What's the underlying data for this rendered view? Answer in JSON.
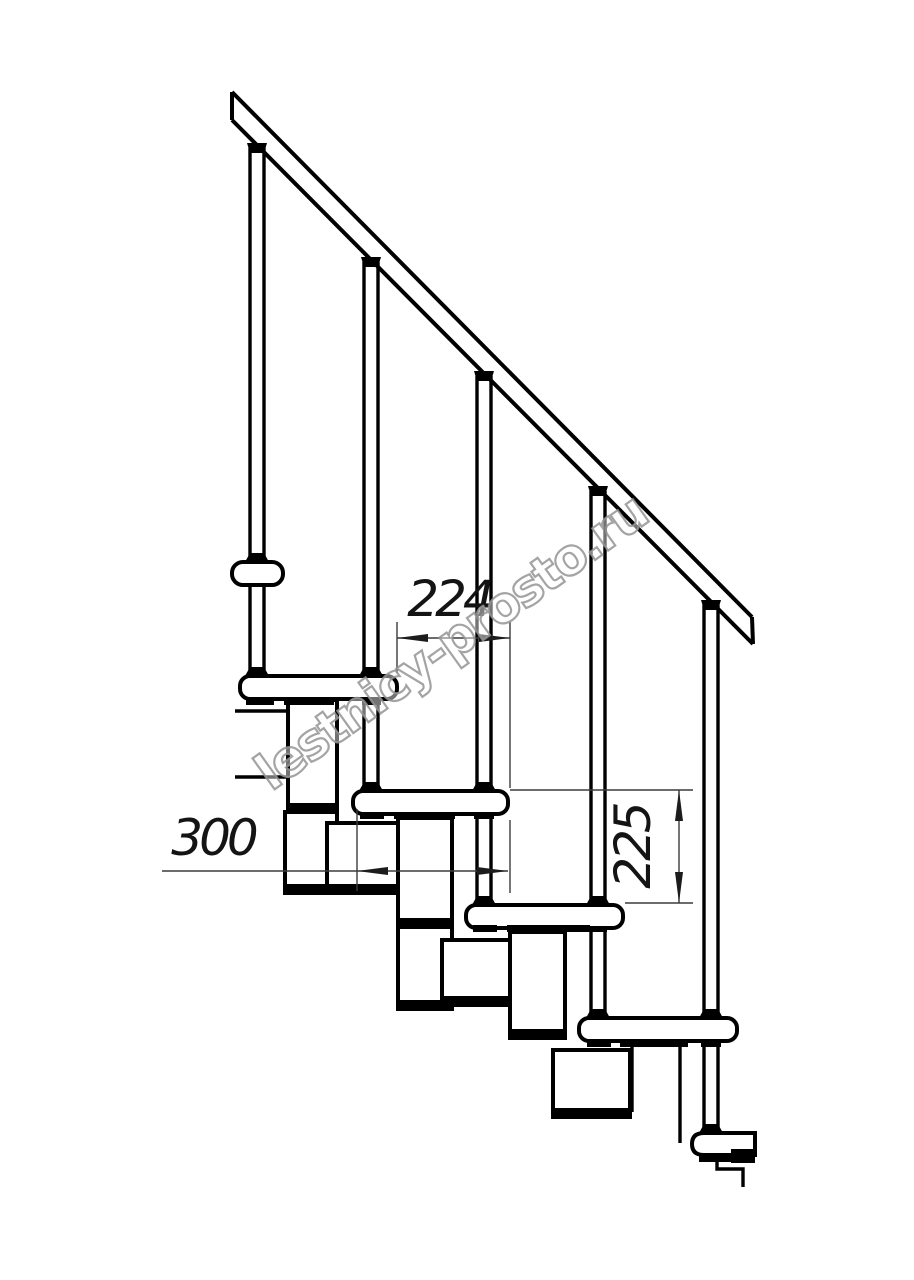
{
  "drawing": {
    "watermark": "lestnicy-prosto.ru",
    "dimensions": {
      "upper_horizontal": "224",
      "lower_horizontal": "300",
      "vertical": "225"
    }
  }
}
